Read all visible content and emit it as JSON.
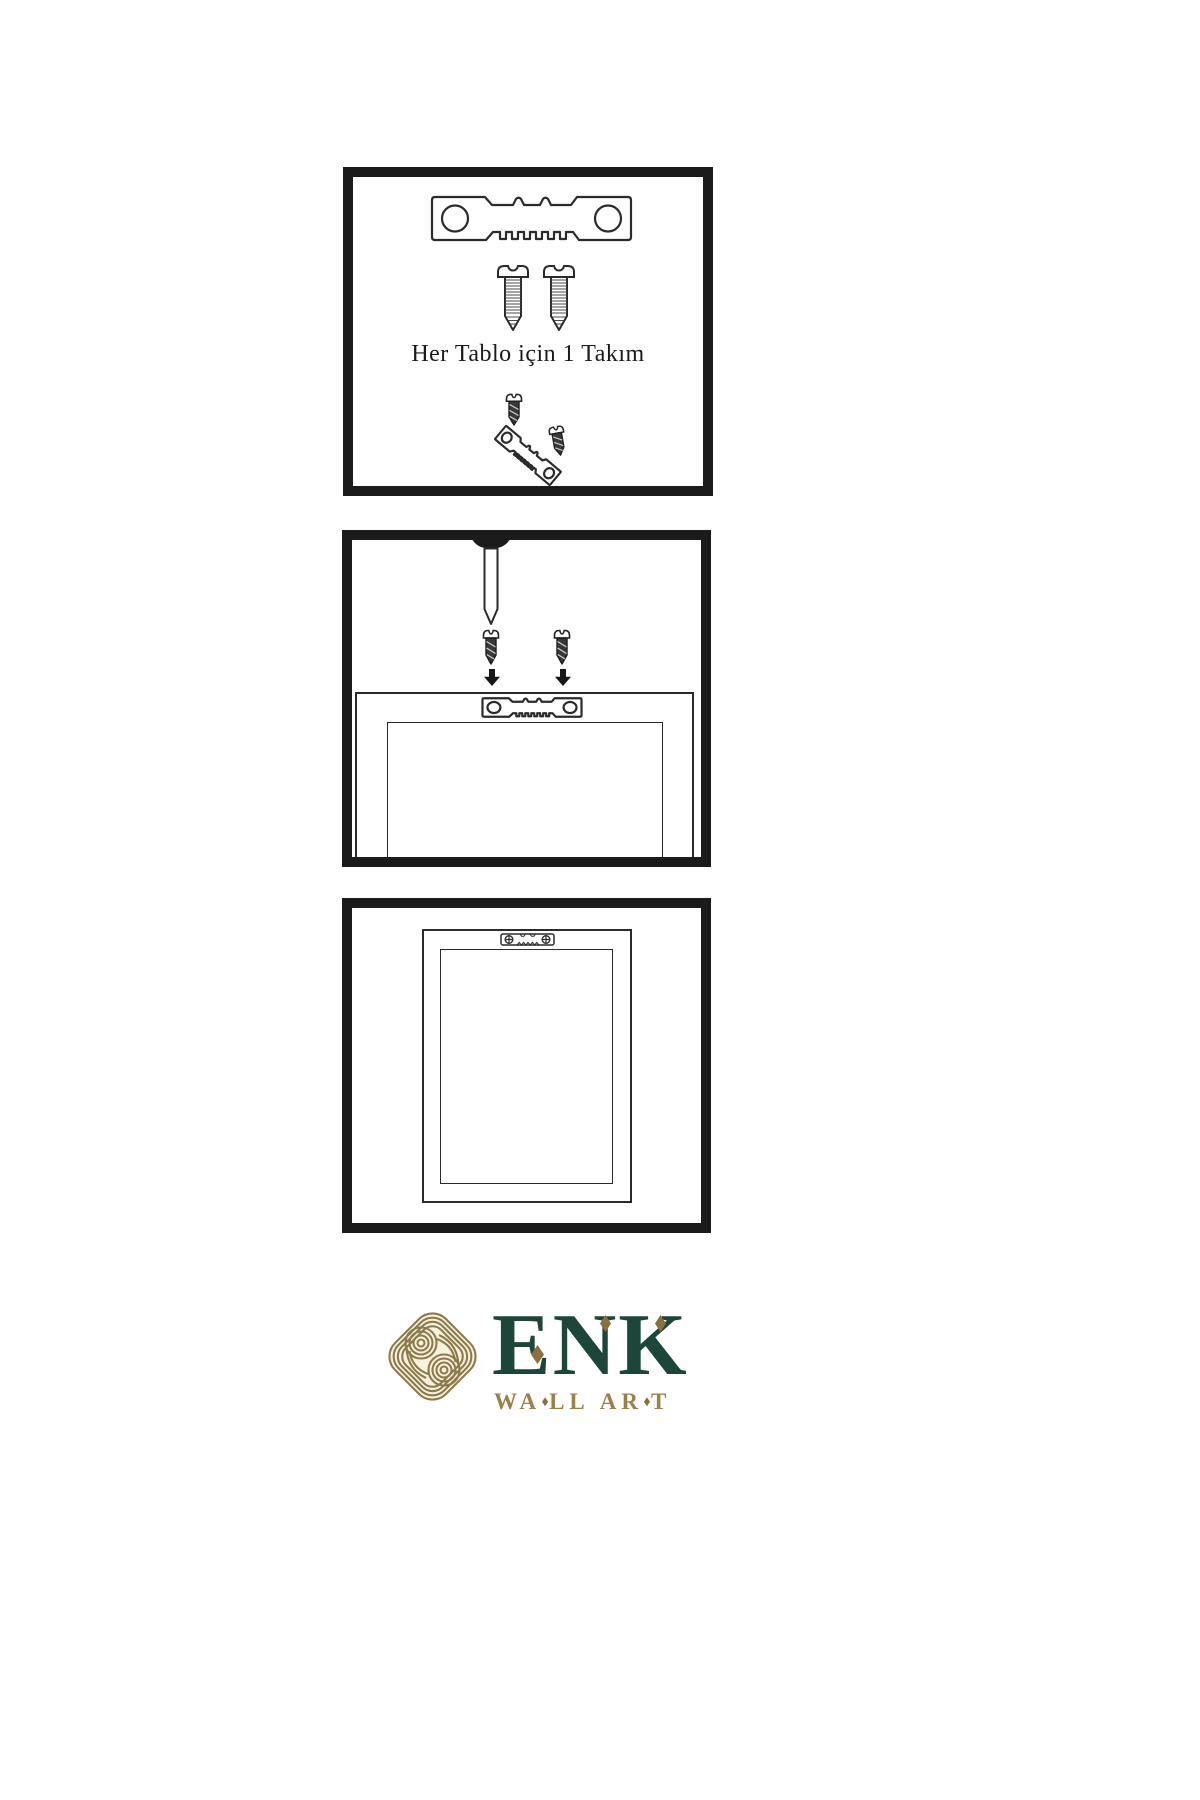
{
  "steps": {
    "kit": {
      "caption": "Her Tablo için 1 Takım"
    }
  },
  "logo": {
    "brand": "ENK",
    "letters": [
      "E",
      "N",
      "K"
    ],
    "tagline": "WALL ART",
    "tagline_parts": [
      "WA",
      "LL",
      "AR",
      "T"
    ]
  },
  "colors": {
    "panel_border": "#1b1b1b",
    "line_art": "#2b2b2b",
    "screw_fill": "#383838",
    "logo_gold": "#8b7a4c",
    "logo_cream": "#f8f1de",
    "logo_green": "#1c4639",
    "tagline_gold": "#9c8048",
    "diamond_gold": "#8b6f3e"
  },
  "graphics": {
    "step1": [
      "sawtooth-hanger-icon",
      "screw-icon",
      "screw-icon",
      "screw-icon",
      "angled-sawtooth-hanger-icon",
      "screw-icon"
    ],
    "step2": [
      "nail-icon",
      "screw-icon",
      "down-arrow-icon",
      "screw-icon",
      "down-arrow-icon",
      "frame-back-icon",
      "sawtooth-hanger-icon"
    ],
    "step3": [
      "framed-picture-back-icon",
      "sawtooth-hanger-icon"
    ],
    "footer": [
      "knot-logo-icon"
    ]
  }
}
